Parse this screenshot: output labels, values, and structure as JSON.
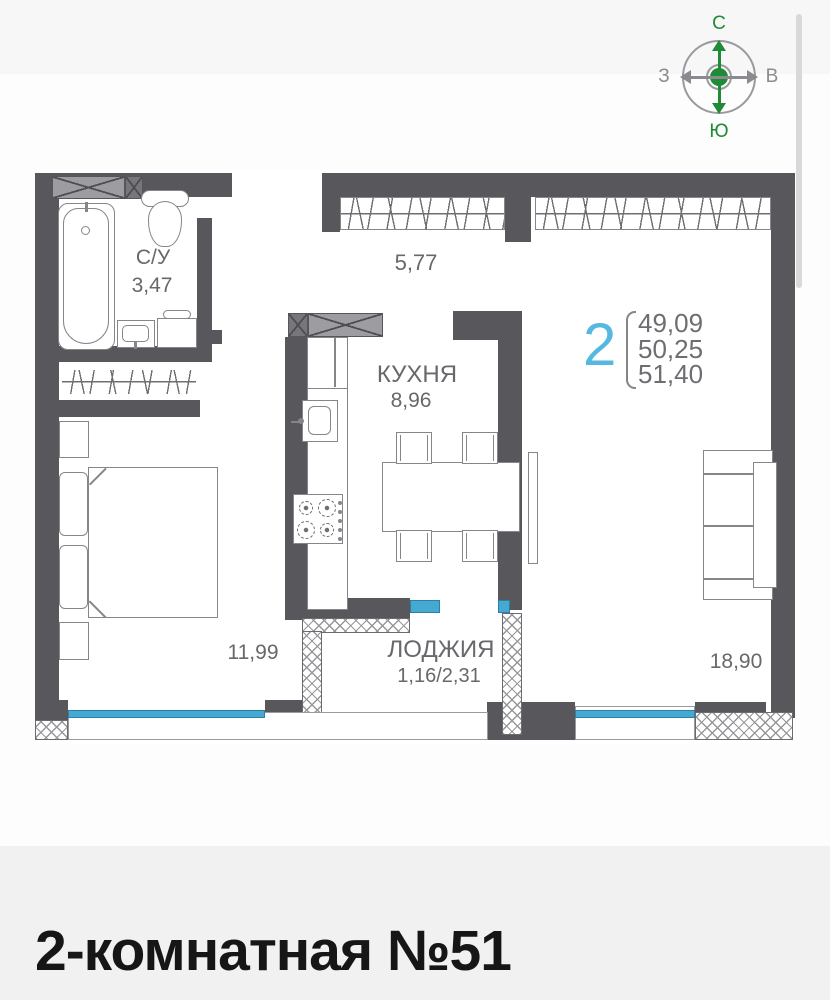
{
  "compass": {
    "north": "С",
    "south": "Ю",
    "west": "З",
    "east": "В"
  },
  "plan": {
    "bathroom": {
      "label": "С/У",
      "area": "3,47"
    },
    "hallway": {
      "area": "5,77"
    },
    "kitchen": {
      "label": "КУХНЯ",
      "area": "8,96"
    },
    "bedroom": {
      "area": "11,99"
    },
    "loggia": {
      "label": "ЛОДЖИЯ",
      "area": "1,16/2,31"
    },
    "living_room": {
      "area": "18,90"
    }
  },
  "summary": {
    "rooms_count": "2",
    "areas": [
      "49,09",
      "50,25",
      "51,40"
    ]
  },
  "footer": {
    "title": "2-комнатная №51"
  },
  "colors": {
    "accent_blue": "#55b8e0",
    "window_teal": "#44aad2",
    "compass_green": "#1f8b36",
    "wall_gray": "#58585c"
  }
}
